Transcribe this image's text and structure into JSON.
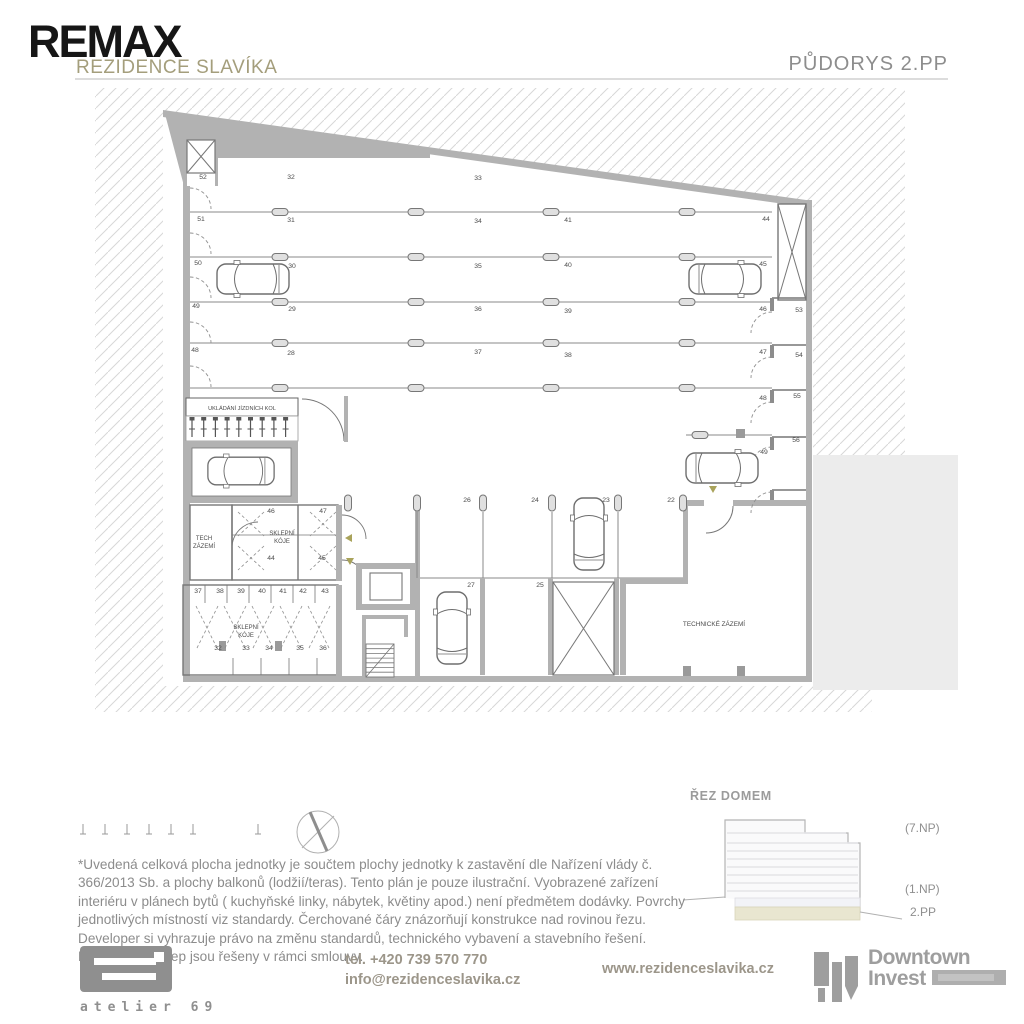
{
  "header": {
    "brand": "REMAX",
    "project": "REZIDENCE SLAVÍKA",
    "page_title": "PŮDORYS 2.PP"
  },
  "plan": {
    "labels": [
      {
        "t": "52",
        "x": 203,
        "y": 179
      },
      {
        "t": "51",
        "x": 201,
        "y": 221
      },
      {
        "t": "50",
        "x": 198,
        "y": 265
      },
      {
        "t": "49",
        "x": 196,
        "y": 308
      },
      {
        "t": "48",
        "x": 195,
        "y": 352
      },
      {
        "t": "32",
        "x": 291,
        "y": 179
      },
      {
        "t": "31",
        "x": 291,
        "y": 222
      },
      {
        "t": "30",
        "x": 292,
        "y": 268
      },
      {
        "t": "29",
        "x": 292,
        "y": 311
      },
      {
        "t": "28",
        "x": 291,
        "y": 355
      },
      {
        "t": "33",
        "x": 478,
        "y": 180
      },
      {
        "t": "34",
        "x": 478,
        "y": 223
      },
      {
        "t": "35",
        "x": 478,
        "y": 268
      },
      {
        "t": "36",
        "x": 478,
        "y": 311
      },
      {
        "t": "37",
        "x": 478,
        "y": 354
      },
      {
        "t": "41",
        "x": 568,
        "y": 222
      },
      {
        "t": "40",
        "x": 568,
        "y": 267
      },
      {
        "t": "39",
        "x": 568,
        "y": 313
      },
      {
        "t": "38",
        "x": 568,
        "y": 357
      },
      {
        "t": "44",
        "x": 766,
        "y": 221
      },
      {
        "t": "45",
        "x": 763,
        "y": 266
      },
      {
        "t": "46",
        "x": 763,
        "y": 311
      },
      {
        "t": "47",
        "x": 763,
        "y": 354
      },
      {
        "t": "48",
        "x": 763,
        "y": 400
      },
      {
        "t": "49",
        "x": 764,
        "y": 454
      },
      {
        "t": "53",
        "x": 799,
        "y": 312
      },
      {
        "t": "54",
        "x": 799,
        "y": 357
      },
      {
        "t": "55",
        "x": 797,
        "y": 398
      },
      {
        "t": "56",
        "x": 796,
        "y": 442
      },
      {
        "t": "26",
        "x": 467,
        "y": 502
      },
      {
        "t": "24",
        "x": 535,
        "y": 502
      },
      {
        "t": "23",
        "x": 606,
        "y": 502
      },
      {
        "t": "22",
        "x": 671,
        "y": 502
      },
      {
        "t": "27",
        "x": 471,
        "y": 587
      },
      {
        "t": "25",
        "x": 540,
        "y": 587
      },
      {
        "t": "46",
        "x": 271,
        "y": 513
      },
      {
        "t": "47",
        "x": 323,
        "y": 513
      },
      {
        "t": "44",
        "x": 271,
        "y": 560
      },
      {
        "t": "45",
        "x": 322,
        "y": 560
      },
      {
        "t": "37",
        "x": 198,
        "y": 593
      },
      {
        "t": "38",
        "x": 220,
        "y": 593
      },
      {
        "t": "39",
        "x": 241,
        "y": 593
      },
      {
        "t": "40",
        "x": 262,
        "y": 593
      },
      {
        "t": "41",
        "x": 283,
        "y": 593
      },
      {
        "t": "42",
        "x": 303,
        "y": 593
      },
      {
        "t": "43",
        "x": 325,
        "y": 593
      },
      {
        "t": "32",
        "x": 218,
        "y": 650
      },
      {
        "t": "33",
        "x": 246,
        "y": 650
      },
      {
        "t": "34",
        "x": 269,
        "y": 650
      },
      {
        "t": "35",
        "x": 300,
        "y": 650
      },
      {
        "t": "36",
        "x": 323,
        "y": 650
      },
      {
        "t": "UKLÁDÁNÍ JÍZDNÍCH KOL",
        "x": 242,
        "y": 410,
        "s": 5.6
      },
      {
        "t": "TECH",
        "x": 204,
        "y": 540,
        "s": 6
      },
      {
        "t": "ZÁZEMÍ",
        "x": 204,
        "y": 548,
        "s": 6
      },
      {
        "t": "SKLEPNÍ",
        "x": 282,
        "y": 535,
        "s": 6
      },
      {
        "t": "KÓJE",
        "x": 282,
        "y": 543,
        "s": 6
      },
      {
        "t": "SKLEPNÍ",
        "x": 246,
        "y": 629,
        "s": 6
      },
      {
        "t": "KÓJE",
        "x": 246,
        "y": 637,
        "s": 6
      },
      {
        "t": "TECHNICKÉ ZÁZEMÍ",
        "x": 714,
        "y": 626,
        "s": 6.4
      }
    ]
  },
  "section": {
    "title": "ŘEZ DOMEM",
    "floor_top": "(7.NP)",
    "floor_ground": "(1.NP)",
    "floor_current": "2.PP"
  },
  "disclaimer": "*Uvedená celková plocha jednotky je součtem plochy jednotky k zastavění dle Nařízení vlády č. 366/2013 Sb. a plochy balkonů (lodžií/teras). Tento plán je pouze ilustrační. Vyobrazené zařízení interiéru v plánech bytů ( kuchyňské linky, nábytek, květiny apod.) není předmětem dodávky. Povrchy jednotlivých místností viz standardy. Čerchované čáry znázorňují konstrukce nad rovinou řezu. Developer si vyhrazuje právo na změnu standardů, technického vybavení a stavebního řešení. Parkování a sklep jsou řešeny v rámci smlouvy.",
  "footer": {
    "studio": "atelier 69",
    "phone": "tel. +420 739 570 770",
    "email": "info@rezidenceslavika.cz",
    "web": "www.rezidenceslavika.cz",
    "developer": [
      "Downtown",
      "Invest"
    ]
  },
  "colors": {
    "accent_olive": "#a49e7c",
    "wall_gray": "#b2b2b2",
    "text_gray": "#8c8c8c",
    "current_floor_beige": "#e9e6d0",
    "marker_olive": "#a9a35b"
  }
}
